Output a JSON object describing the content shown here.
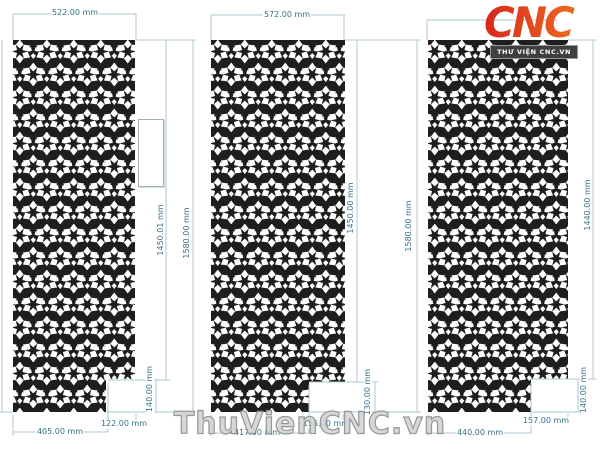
{
  "header": {
    "logo_text": "CNC",
    "logo_banner": "THƯ VIỆN CNC.VN"
  },
  "watermark_text": "ThuVienCNC.vn",
  "unit": "mm",
  "colors": {
    "panel_fill": "#1e1e1e",
    "pattern_cut": "#ffffff",
    "dim_line": "#aecad4",
    "dim_text": "#33708a",
    "logo_red": "#d6281c",
    "logo_orange": "#f08118",
    "watermark_gray": "#d4d4d4"
  },
  "panels": [
    {
      "id": "panel-1",
      "dims": {
        "top_width": "522.00 mm",
        "side_height": "1450.01 mm",
        "bottom_width": "405.00 mm",
        "notch_width": "122.00 mm",
        "notch_height": "140.00 mm"
      }
    },
    {
      "id": "panel-2",
      "dims": {
        "top_width": "572.00 mm",
        "left_height": "1580.00 mm",
        "side_height": "1450.00 mm",
        "bottom_width": "417.00 mm",
        "notch_width": "155.00 mm",
        "notch_height": "130.00 mm"
      }
    },
    {
      "id": "panel-3",
      "dims": {
        "left_height": "1580.00 mm",
        "side_height": "1440.00 mm",
        "bottom_width": "440.00 mm",
        "notch_width": "157.00 mm",
        "notch_height": "140.00 mm"
      }
    }
  ]
}
